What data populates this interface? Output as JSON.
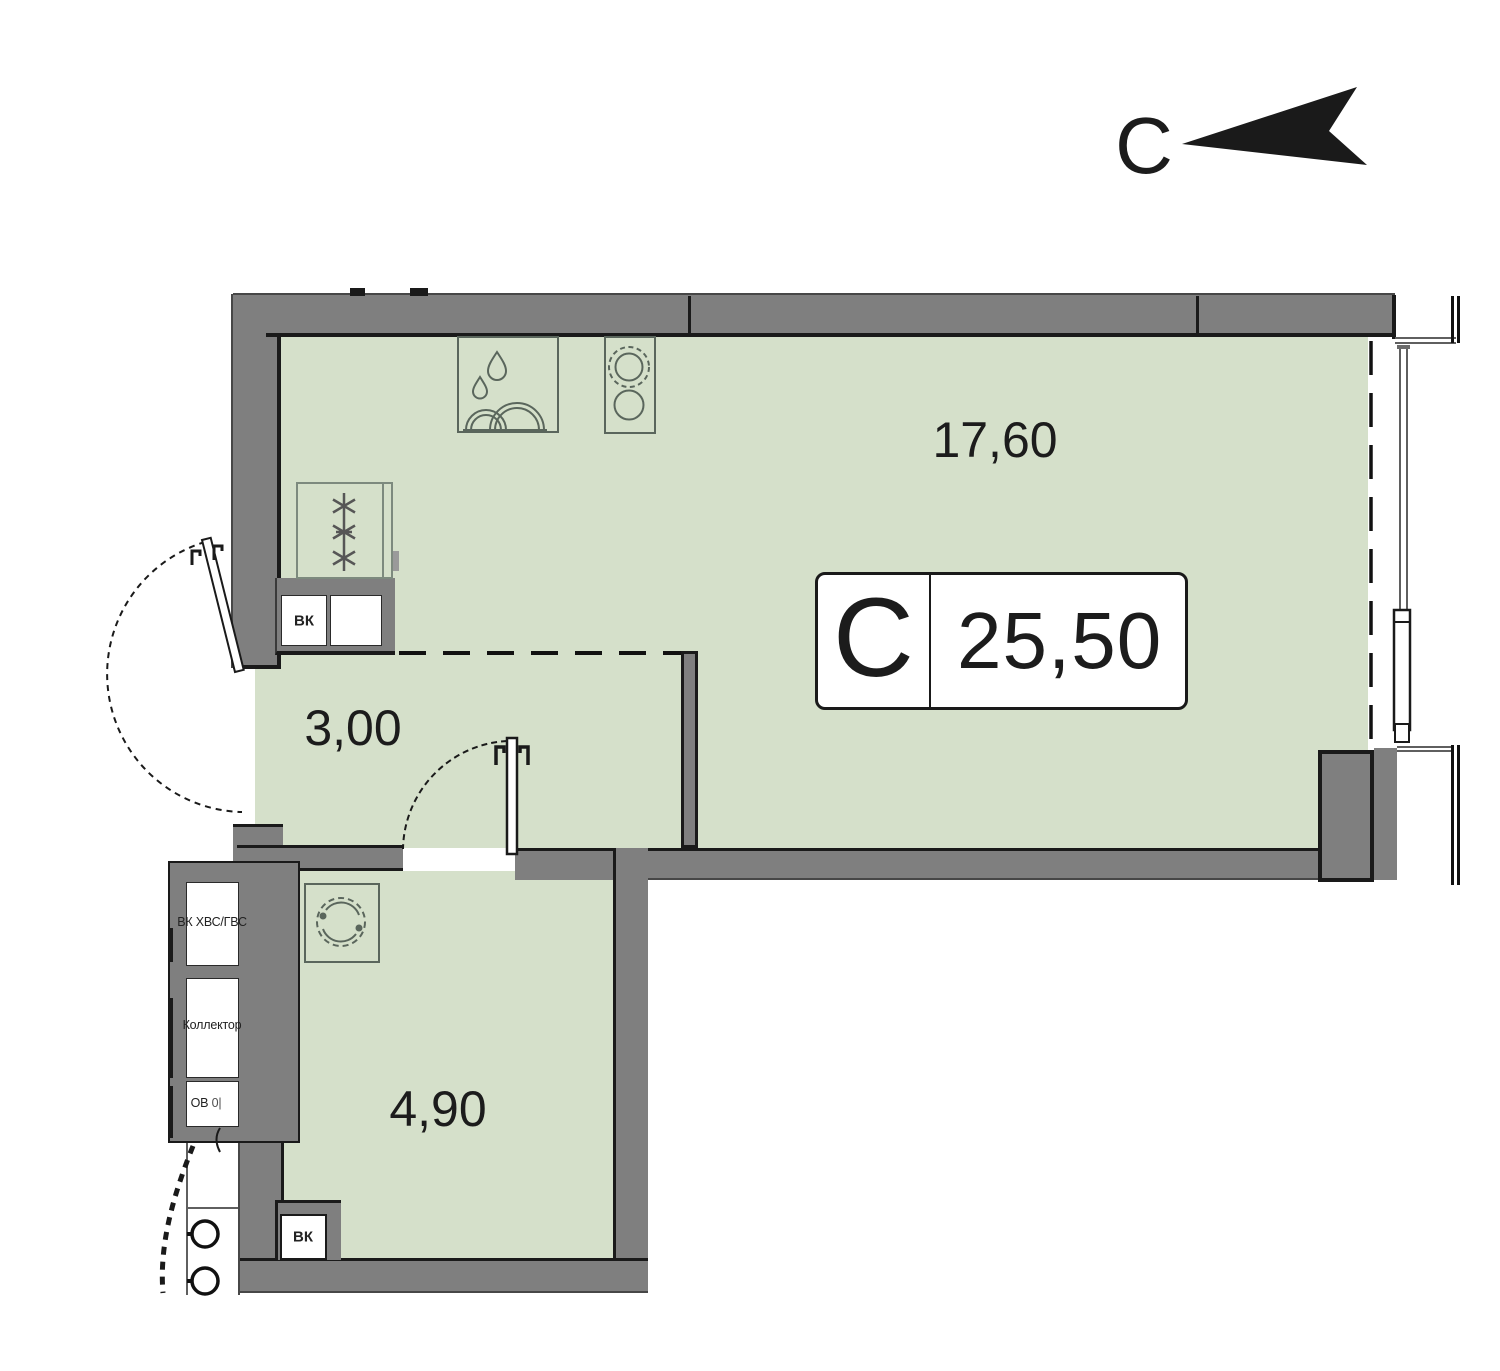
{
  "title": "Floor plan of studio apartment С, 25.50 m²",
  "north": {
    "label": "С"
  },
  "unit_badge": {
    "type_letter": "С",
    "area": "25,50"
  },
  "rooms": {
    "living_kitchen": {
      "area_label": "17,60"
    },
    "hallway": {
      "area_label": "3,00"
    },
    "bathroom": {
      "area_label": "4,90"
    }
  },
  "shaft": {
    "cells": [
      {
        "label": "ВК ХВС/ГВС"
      },
      {
        "label": "Коллектор"
      },
      {
        "label": "ОВ",
        "sub": "0|"
      }
    ]
  },
  "vents": {
    "kitchen_label": "ВК",
    "bathroom_label": "ВК"
  },
  "colors": {
    "floor": "#d5e0ca",
    "wall": "#7f7f7f",
    "outline": "#1a1a1a",
    "fixture": "#5a665c"
  }
}
